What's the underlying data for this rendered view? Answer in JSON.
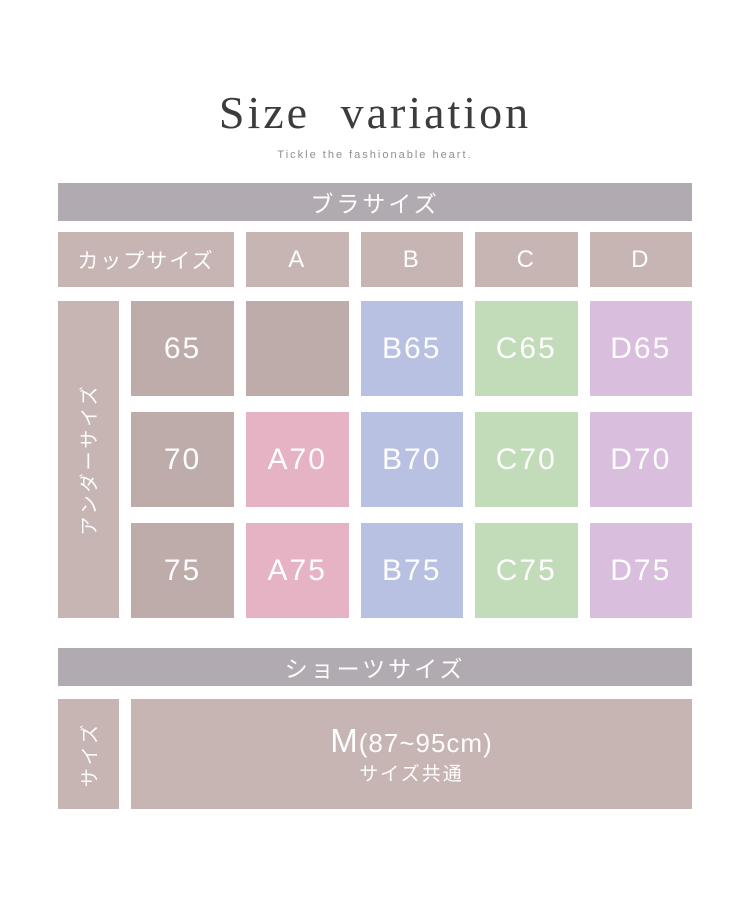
{
  "page": {
    "title": "Size variation",
    "subtitle": "Tickle the fashionable heart."
  },
  "bra": {
    "header": "ブラサイズ",
    "cup_label": "カップサイズ",
    "cups": [
      "A",
      "B",
      "C",
      "D"
    ],
    "under_label": "アンダーサイズ",
    "rows": [
      {
        "under": "65",
        "cells": [
          {
            "text": "",
            "type": "blank"
          },
          {
            "text": "B65",
            "type": "blue"
          },
          {
            "text": "C65",
            "type": "green"
          },
          {
            "text": "D65",
            "type": "lilac"
          }
        ]
      },
      {
        "under": "70",
        "cells": [
          {
            "text": "A70",
            "type": "pink"
          },
          {
            "text": "B70",
            "type": "blue"
          },
          {
            "text": "C70",
            "type": "green"
          },
          {
            "text": "D70",
            "type": "lilac"
          }
        ]
      },
      {
        "under": "75",
        "cells": [
          {
            "text": "A75",
            "type": "pink"
          },
          {
            "text": "B75",
            "type": "blue"
          },
          {
            "text": "C75",
            "type": "green"
          },
          {
            "text": "D75",
            "type": "lilac"
          }
        ]
      }
    ]
  },
  "shorts": {
    "header": "ショーツサイズ",
    "side_label": "サイズ",
    "size_main": "M",
    "size_range": "(87~95cm)",
    "size_note": "サイズ共通"
  },
  "colors": {
    "bar": "#b1abb1",
    "taupe_light": "#c6b5b3",
    "taupe": "#bdacaa",
    "pink": "#e6b3c5",
    "blue": "#b9c1e2",
    "green": "#c2dbb8",
    "lilac": "#d9bedd",
    "title": "#3c3c3c",
    "subtitle": "#8f8f8f",
    "celltext": "#fdfdfd"
  }
}
